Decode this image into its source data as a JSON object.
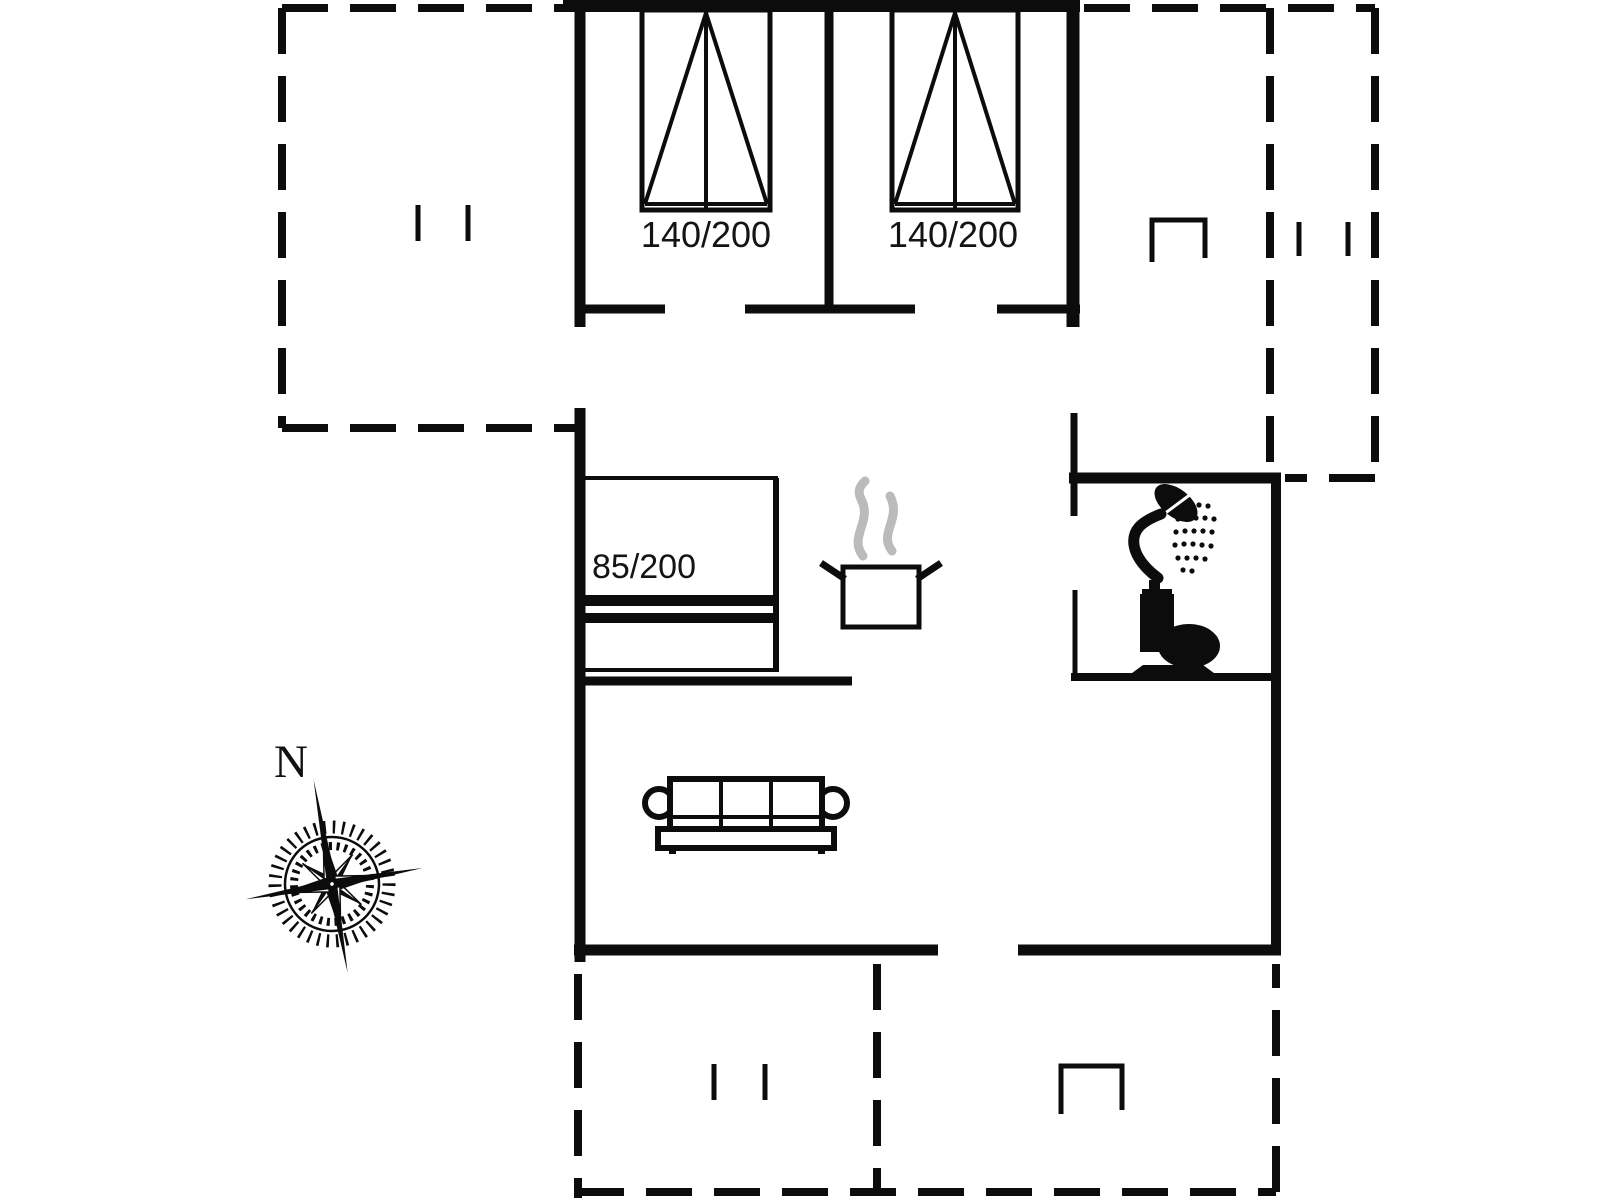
{
  "floorplan": {
    "background_color": "#ffffff",
    "line_color": "#0c0c0c",
    "steam_color": "#bbbbbb",
    "labels": {
      "double_bed_1": "140/200",
      "double_bed_2": "140/200",
      "single_bed": "85/200",
      "compass_north": "N"
    },
    "icons": [
      "double-bed-icon",
      "double-bed-icon",
      "single-bed-icon",
      "cooking-pot-icon",
      "steam-icon",
      "shower-icon",
      "toilet-icon",
      "sofa-icon",
      "compass-rose-icon",
      "door-mark-ticks",
      "wall-bracket"
    ]
  }
}
